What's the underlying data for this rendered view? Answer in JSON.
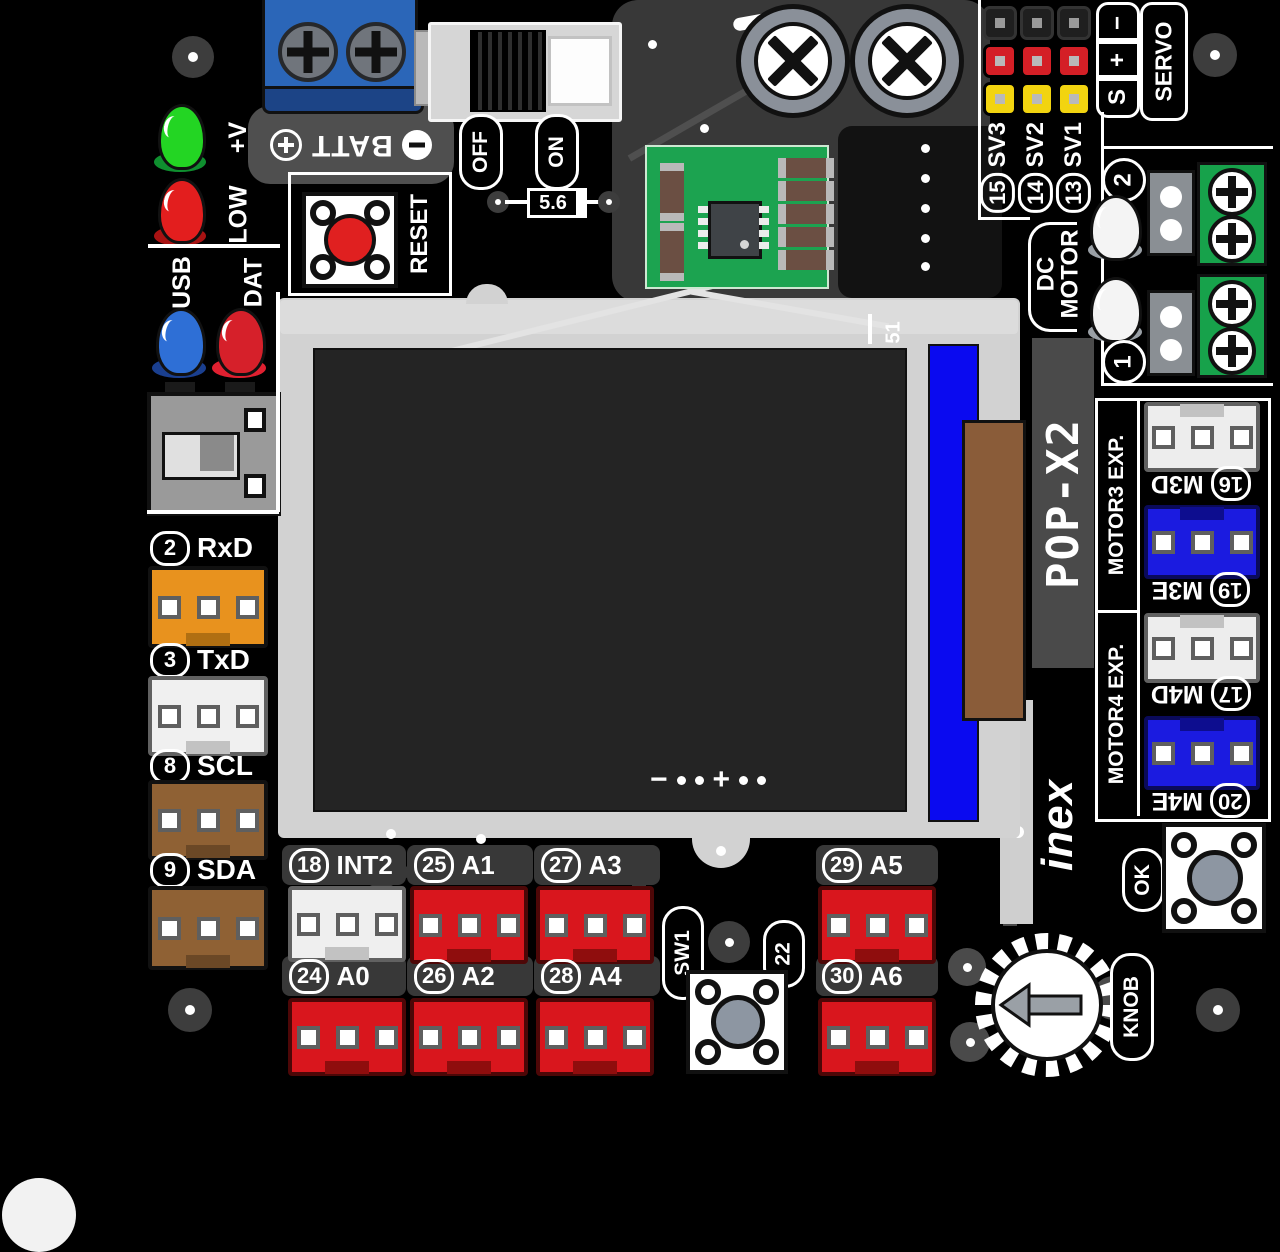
{
  "board": {
    "name": "POP-X2",
    "brand": "inex",
    "silkscreen": {
      "batt": "BATT",
      "batt_plus": "+",
      "batt_minus": "−",
      "off": "OFF",
      "on": "ON",
      "fuse": "5.6",
      "reset": "RESET",
      "servo": "SERVO",
      "servo_rows": [
        "−",
        "+",
        "S"
      ],
      "dc_motor": [
        "DC",
        "MOTOR"
      ],
      "motor3_title": "MOTOR3 EXP.",
      "motor4_title": "MOTOR4 EXP.",
      "sw1": "SW1",
      "sw1_pin": "22",
      "ok": "OK",
      "knob": "KNOB",
      "screen_marker": "51",
      "backlight_minus": "−",
      "backlight_plus": "+"
    },
    "status_leds": [
      {
        "label": "+V",
        "color": "#23d523"
      },
      {
        "label": "LOW",
        "color": "#e31e1e"
      },
      {
        "label": "USB",
        "color": "#2e6fd6"
      },
      {
        "label": "DAT",
        "color": "#d6202a"
      }
    ],
    "left_ports": [
      {
        "pin": "2",
        "name": "RxD",
        "color": "#e8921e"
      },
      {
        "pin": "3",
        "name": "TxD",
        "color": "#f0f0f0"
      },
      {
        "pin": "8",
        "name": "SCL",
        "color": "#8f6134"
      },
      {
        "pin": "9",
        "name": "SDA",
        "color": "#8f6134"
      }
    ],
    "servo_channels": [
      {
        "pin": "15",
        "name": "SV3"
      },
      {
        "pin": "14",
        "name": "SV2"
      },
      {
        "pin": "13",
        "name": "SV1"
      }
    ],
    "dc_motor_channels": [
      "2",
      "1"
    ],
    "motor_exp_ports": [
      {
        "pin": "16",
        "name": "M3D",
        "color": "#ededed"
      },
      {
        "pin": "19",
        "name": "M3E",
        "color": "#1b1be0"
      },
      {
        "pin": "17",
        "name": "M4D",
        "color": "#ededed"
      },
      {
        "pin": "20",
        "name": "M4E",
        "color": "#1b1be0"
      }
    ],
    "io_ports_row1": [
      {
        "pin": "18",
        "name": "INT2",
        "color": "#efefef"
      },
      {
        "pin": "25",
        "name": "A1",
        "color": "#d9161d"
      },
      {
        "pin": "27",
        "name": "A3",
        "color": "#d9161d"
      },
      {
        "pin": "29",
        "name": "A5",
        "color": "#d9161d"
      }
    ],
    "io_ports_row2": [
      {
        "pin": "24",
        "name": "A0",
        "color": "#d9161d"
      },
      {
        "pin": "26",
        "name": "A2",
        "color": "#d9161d"
      },
      {
        "pin": "28",
        "name": "A4",
        "color": "#d9161d"
      },
      {
        "pin": "30",
        "name": "A6",
        "color": "#d9161d"
      }
    ],
    "colors": {
      "board": "#000000",
      "copper_zone": "#383838",
      "lcd_frame": "#d2d2d2",
      "lcd_screen": "#242424",
      "lcd_flex": "#0a0af0",
      "lcd_connector": "#8a5c39",
      "servo_pin_rows": [
        "#1f1f1f",
        "#d41f26",
        "#f2d410"
      ],
      "green_terminal": "#17a24b",
      "battery_terminal": "#2b66b8"
    }
  }
}
